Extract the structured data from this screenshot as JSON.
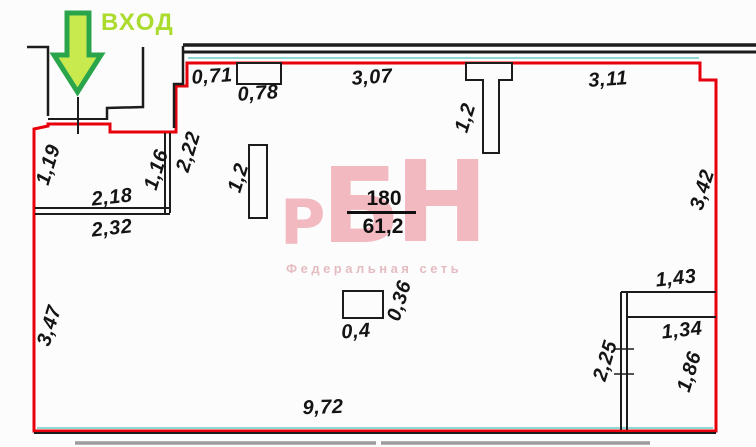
{
  "entrance": {
    "label": "ВХОД",
    "arrow_fill": "#c8ea4f",
    "arrow_border": "#2ba54b",
    "label_color": "#abdb2d"
  },
  "room_label": {
    "number": "180",
    "area": "61,2"
  },
  "watermark": {
    "letter_1": "Р",
    "letter_2": "Б",
    "letter_3": "Н",
    "subtitle": "Федеральная сеть",
    "color": "#f3b9c1",
    "subtitle_color": "#e5bcc1"
  },
  "colors": {
    "outline_red": "#e8000c",
    "wall_black": "#1c1c1c",
    "artifact_teal": "#6cc9c4",
    "lower_wall_gray": "#9c9c9c"
  },
  "dimensions": {
    "top_offset": "0,71",
    "top_niche_width": "0,78",
    "top_span_left": "3,07",
    "top_span_right": "3,11",
    "top_column_depth": "1,2",
    "vestibule_left_depth": "1,19",
    "vestibule_right_depth": "1,16",
    "vestibule_inner_width": "2,18",
    "vestibule_outer_width": "2,32",
    "entry_recess_depth": "2,22",
    "partition_length": "1,2",
    "pillar_width": "0,4",
    "pillar_depth": "0,36",
    "right_wall_upper": "3,42",
    "left_wall_lower": "3,47",
    "bottom_width": "9,72",
    "closet_outer_width": "1,43",
    "closet_inner_width": "1,34",
    "closet_wall_height": "2,25",
    "closet_inner_height": "1,86"
  }
}
